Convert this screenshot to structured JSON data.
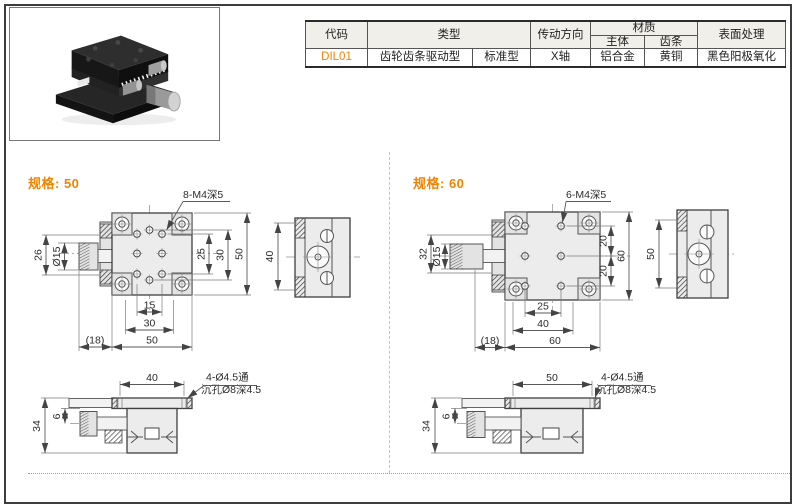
{
  "accent_color": "#f08300",
  "table": {
    "headers": {
      "code": "代码",
      "type": "类型",
      "direction": "传动方向",
      "material": "材质",
      "material_body": "主体",
      "material_rack": "齿条",
      "surface": "表面处理"
    },
    "row": {
      "code": "DIL01",
      "type_main": "齿轮齿条驱动型",
      "type_sub": "标准型",
      "direction": "X轴",
      "material_body": "铝合金",
      "material_rack": "黄铜",
      "surface": "黑色阳极氧化"
    }
  },
  "sections": [
    {
      "title": "规格: 50",
      "top": {
        "callout": "8-M4深5",
        "knob_len": "26",
        "knob_dia": "Ø15",
        "right_inner": "25",
        "right_mid": "30",
        "right_outer": "50",
        "bottom_inner": "15",
        "bottom_mid": "30",
        "bottom_outer": "50",
        "overhang": "(18)"
      },
      "side": {
        "height": "40"
      },
      "front": {
        "span": "40",
        "height": "34",
        "offset": "6",
        "callout1": "4-Ø4.5通",
        "callout2": "沉孔Ø8深4.5"
      }
    },
    {
      "title": "规格: 60",
      "top": {
        "callout": "6-M4深5",
        "knob_len": "32",
        "knob_dia": "Ø15",
        "right_inner": "20",
        "right_inner2": "20",
        "right_outer": "60",
        "bottom_inner": "25",
        "bottom_mid": "40",
        "bottom_outer": "60",
        "overhang": "(18)"
      },
      "side": {
        "height": "50"
      },
      "front": {
        "span": "50",
        "height": "34",
        "offset": "6",
        "callout1": "4-Ø4.5通",
        "callout2": "沉孔Ø8深4.5"
      }
    }
  ]
}
